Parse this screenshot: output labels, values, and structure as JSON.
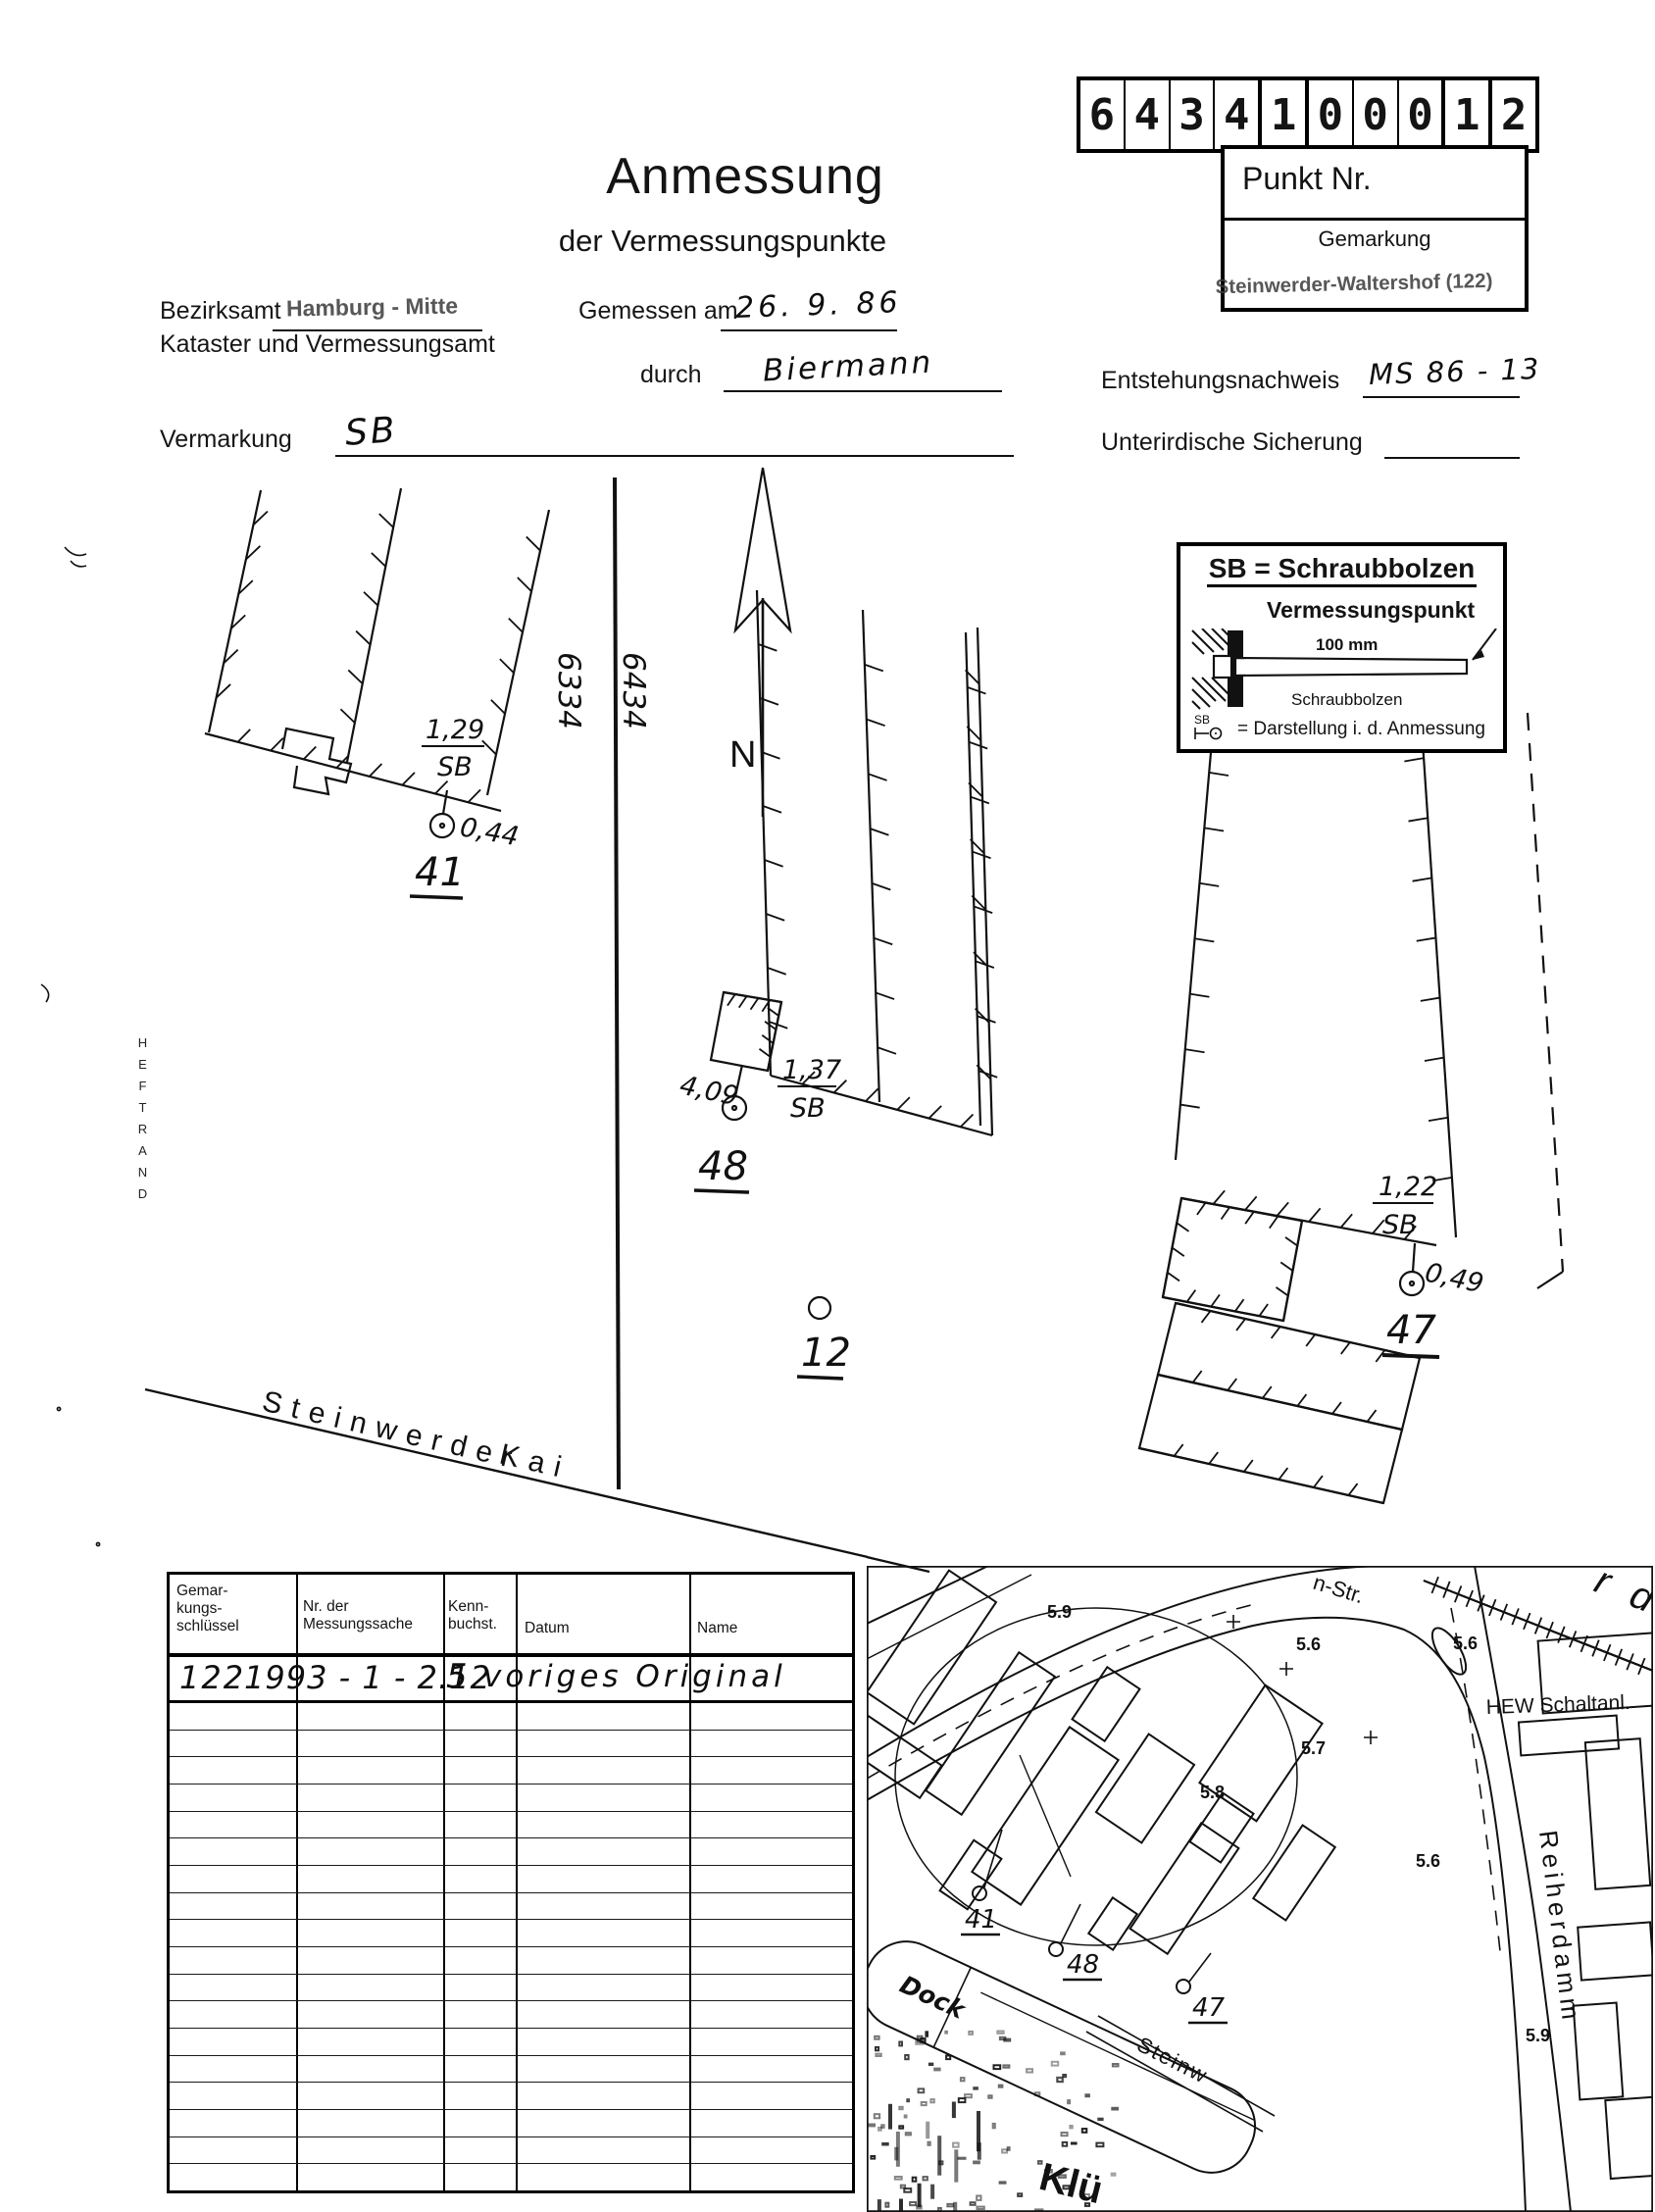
{
  "document": {
    "title": "Anmessung",
    "subtitle": "der Vermessungspunkte",
    "point_number": {
      "digits": [
        "6",
        "4",
        "3",
        "4",
        "1",
        "0",
        "0",
        "0",
        "1",
        "2"
      ],
      "punkt_label": "Punkt Nr.",
      "gemarkung_label": "Gemarkung",
      "gemarkung_stamp": "Steinwerder-Waltershof (122)"
    },
    "fields": {
      "bezirksamt_label": "Bezirksamt",
      "bezirksamt_value": "Hamburg - Mitte",
      "kataster_label": "Kataster und Vermessungsamt",
      "gemessen_label": "Gemessen am",
      "gemessen_value": "26. 9. 86",
      "durch_label": "durch",
      "durch_value": "Biermann",
      "entstehung_label": "Entstehungsnachweis",
      "entstehung_value": "MS 86 - 13",
      "vermarkung_label": "Vermarkung",
      "vermarkung_value": "SB",
      "sicherung_label": "Unterirdische Sicherung"
    },
    "margin_label": "HEFTRAND"
  },
  "legend": {
    "title": "SB = Schraubbolzen",
    "point_label": "Vermessungspunkt",
    "dimension": "100 mm",
    "bolt_label": "Schraubbolzen",
    "symbol_label": "SB",
    "explanation": "= Darstellung i. d. Anmessung"
  },
  "sketch": {
    "parcel_left": "6334",
    "parcel_right": "6434",
    "north": "N",
    "street_name": "Steinwerder",
    "street_suffix": "Kai",
    "p41": {
      "label": "41",
      "offset_top": "1,29",
      "marker": "SB",
      "distance": "0,44"
    },
    "p48": {
      "label": "48",
      "offset_top": "1,37",
      "marker": "SB",
      "distance": "4,09"
    },
    "p47": {
      "label": "47",
      "offset_top": "1,22",
      "marker": "SB",
      "distance": "0,49"
    },
    "p12": {
      "label": "12"
    }
  },
  "table": {
    "headers": [
      "Gemar-\nkungs-\nschlüssel",
      "Nr. der\nMessungssache",
      "Kenn-\nbuchst.",
      "Datum",
      "Name"
    ],
    "row": {
      "gemarkungsschluessel": "122",
      "messungssache": "1993 - 1 - 2.12",
      "kennbuchstabe": "5",
      "note": "voriges  Original"
    },
    "empty_rows": 18
  },
  "map": {
    "street_fragment": "n-Str.",
    "reiherdamm": "Reiherdamm",
    "hew": "HEW Schaltanl.",
    "dock": "Dock",
    "klu": "Klü",
    "steinw": "Steinw",
    "elbe_fragment": "r d e",
    "spot_heights": [
      "5.9",
      "5.6",
      "5.6",
      "5.7",
      "5.8",
      "5.6",
      "5.9"
    ],
    "p41": "41",
    "p48": "48",
    "p47": "47"
  }
}
